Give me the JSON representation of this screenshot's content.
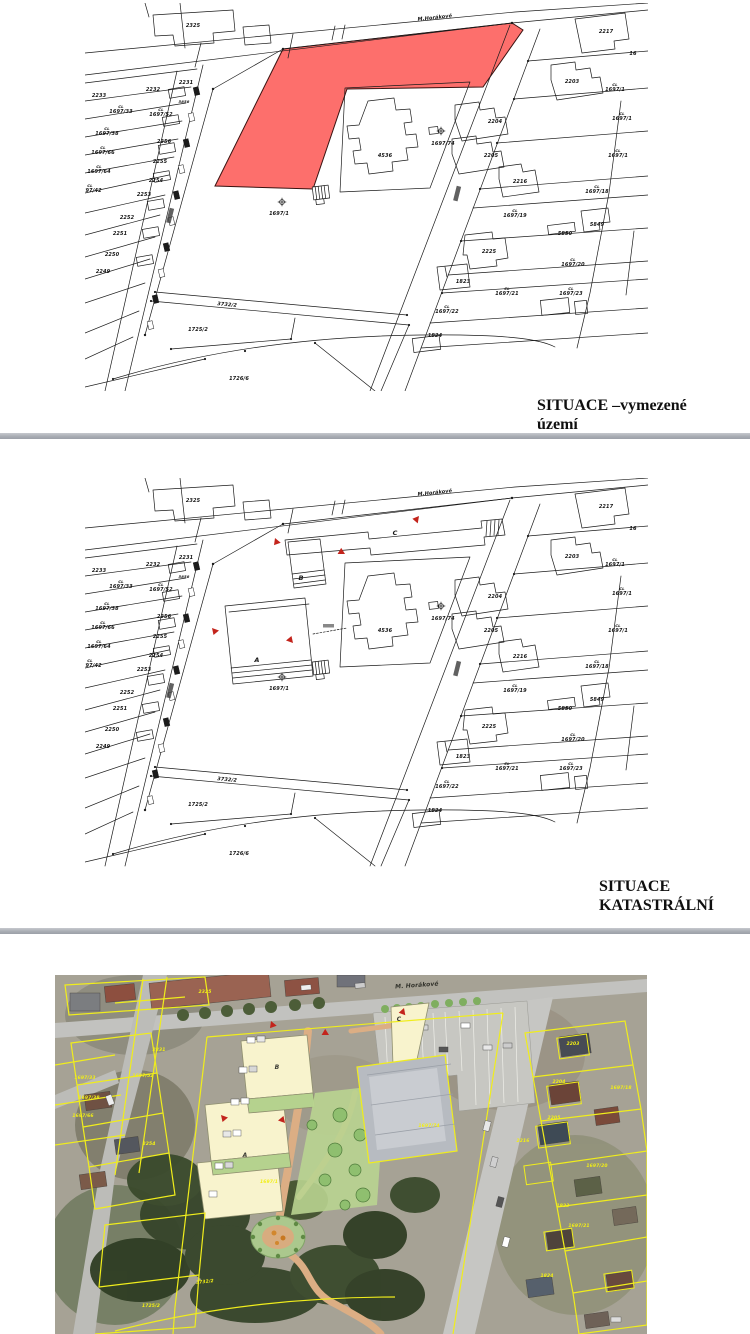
{
  "page": {
    "background": "#ffffff"
  },
  "figure1": {
    "caption": "SITUACE –vymezené\núzemí",
    "highlight_color": "#fd6f6c"
  },
  "figure2": {
    "caption": "SITUACE\nKATASTRÁLNÍ",
    "letters": [
      {
        "t": "C",
        "x": 310,
        "y": 57,
        "s": 6.5
      },
      {
        "t": "B",
        "x": 216,
        "y": 102,
        "s": 6.5
      },
      {
        "t": "A",
        "x": 172,
        "y": 184,
        "s": 6.5
      }
    ]
  },
  "shared": {
    "map_labels": [
      {
        "t": "M.Horákové",
        "x": 350,
        "y": 16,
        "r": -6,
        "s": 5
      },
      {
        "t": "2325",
        "x": 108,
        "y": 24
      },
      {
        "t": "2217",
        "x": 521,
        "y": 30
      },
      {
        "t": "16",
        "x": 548,
        "y": 52
      },
      {
        "t": "2233",
        "x": 14,
        "y": 94
      },
      {
        "t": "2232",
        "x": 68,
        "y": 88
      },
      {
        "t": "2231",
        "x": 101,
        "y": 81
      },
      {
        "t": "5858",
        "x": 99,
        "y": 100,
        "s": 3.8
      },
      {
        "t": "1697/33",
        "x": 36,
        "y": 110,
        "pre": "CL"
      },
      {
        "t": "1697/52",
        "x": 76,
        "y": 113,
        "pre": "CL"
      },
      {
        "t": "1697/38",
        "x": 22,
        "y": 132,
        "pre": "CL"
      },
      {
        "t": "2256",
        "x": 79,
        "y": 140
      },
      {
        "t": "1697/66",
        "x": 18,
        "y": 151,
        "pre": "CL"
      },
      {
        "t": "2255",
        "x": 75,
        "y": 160
      },
      {
        "t": "1697/64",
        "x": 14,
        "y": 170,
        "pre": "CL"
      },
      {
        "t": "2254",
        "x": 71,
        "y": 179
      },
      {
        "t": "1697/42",
        "x": 5,
        "y": 189,
        "pre": "CL"
      },
      {
        "t": "2253",
        "x": 59,
        "y": 193
      },
      {
        "t": "2252",
        "x": 42,
        "y": 216
      },
      {
        "t": "2251",
        "x": 35,
        "y": 232
      },
      {
        "t": "2250",
        "x": 27,
        "y": 253
      },
      {
        "t": "2249",
        "x": 18,
        "y": 270
      },
      {
        "t": "1697/1",
        "x": 194,
        "y": 212
      },
      {
        "t": "4536",
        "x": 300,
        "y": 154
      },
      {
        "t": "1697/74",
        "x": 358,
        "y": 142
      },
      {
        "t": "3732/2",
        "x": 142,
        "y": 303,
        "r": 5
      },
      {
        "t": "1725/2",
        "x": 113,
        "y": 328
      },
      {
        "t": "1726/6",
        "x": 154,
        "y": 377
      },
      {
        "t": "2203",
        "x": 487,
        "y": 80
      },
      {
        "t": "1697/1",
        "x": 530,
        "y": 88,
        "pre": "CL"
      },
      {
        "t": "2204",
        "x": 410,
        "y": 120
      },
      {
        "t": "1697/1",
        "x": 537,
        "y": 117,
        "pre": "CL"
      },
      {
        "t": "2205",
        "x": 406,
        "y": 154
      },
      {
        "t": "1697/1",
        "x": 533,
        "y": 154,
        "pre": "CL"
      },
      {
        "t": "2216",
        "x": 435,
        "y": 180
      },
      {
        "t": "1697/18",
        "x": 512,
        "y": 190,
        "pre": "CL"
      },
      {
        "t": "1697/19",
        "x": 430,
        "y": 214,
        "pre": "CL"
      },
      {
        "t": "5849",
        "x": 512,
        "y": 223
      },
      {
        "t": "5850",
        "x": 480,
        "y": 232
      },
      {
        "t": "2225",
        "x": 404,
        "y": 250
      },
      {
        "t": "1697/20",
        "x": 488,
        "y": 263,
        "pre": "CL"
      },
      {
        "t": "1823",
        "x": 378,
        "y": 280
      },
      {
        "t": "1697/21",
        "x": 422,
        "y": 292,
        "pre": "CL"
      },
      {
        "t": "1697/23",
        "x": 486,
        "y": 292,
        "pre": "CL"
      },
      {
        "t": "1697/22",
        "x": 362,
        "y": 310,
        "pre": "CL"
      },
      {
        "t": "1824",
        "x": 350,
        "y": 334
      }
    ]
  },
  "figure3": {
    "colors": {
      "parcel_line": "#f0ed1c",
      "path": "#dcae84",
      "building": "#f8f3cd",
      "lawn": "#b9d490"
    },
    "labels": [
      {
        "t": "M. Horákové",
        "x": 362,
        "y": 12,
        "r": -4,
        "s": 6,
        "c": "#33332c"
      },
      {
        "t": "2325",
        "x": 150,
        "y": 18,
        "s": 4.5
      },
      {
        "t": "2231",
        "x": 104,
        "y": 76,
        "s": 4.5
      },
      {
        "t": "1697/33",
        "x": 30,
        "y": 104,
        "s": 4.5
      },
      {
        "t": "1697/52",
        "x": 88,
        "y": 102,
        "s": 4.5
      },
      {
        "t": "1697/38",
        "x": 34,
        "y": 124,
        "s": 4.5
      },
      {
        "t": "1697/66",
        "x": 28,
        "y": 142,
        "s": 4.5
      },
      {
        "t": "2254",
        "x": 94,
        "y": 170,
        "s": 4.5
      },
      {
        "t": "2203",
        "x": 518,
        "y": 70,
        "s": 4.5
      },
      {
        "t": "1697/18",
        "x": 566,
        "y": 114,
        "s": 4.5
      },
      {
        "t": "2204",
        "x": 504,
        "y": 108,
        "s": 4.5
      },
      {
        "t": "2205",
        "x": 499,
        "y": 144,
        "s": 4.5
      },
      {
        "t": "2216",
        "x": 468,
        "y": 167,
        "s": 4.5
      },
      {
        "t": "1697/20",
        "x": 542,
        "y": 192,
        "s": 4.5
      },
      {
        "t": "1697/74",
        "x": 374,
        "y": 152,
        "s": 4.5
      },
      {
        "t": "1697/1",
        "x": 214,
        "y": 208,
        "s": 4.5
      },
      {
        "t": "3732/2",
        "x": 150,
        "y": 308,
        "r": -6,
        "s": 4.5
      },
      {
        "t": "1725/2",
        "x": 96,
        "y": 332,
        "s": 4.5
      },
      {
        "t": "1823",
        "x": 508,
        "y": 232,
        "s": 4.5
      },
      {
        "t": "1697/21",
        "x": 524,
        "y": 252,
        "s": 4.5
      },
      {
        "t": "1824",
        "x": 492,
        "y": 302,
        "s": 4.5
      },
      {
        "t": "C",
        "x": 344,
        "y": 46,
        "s": 6,
        "c": "#3a3a33"
      },
      {
        "t": "B",
        "x": 222,
        "y": 94,
        "s": 6,
        "c": "#3a3a33"
      },
      {
        "t": "A",
        "x": 190,
        "y": 182,
        "s": 6,
        "c": "#3a3a33"
      }
    ]
  }
}
